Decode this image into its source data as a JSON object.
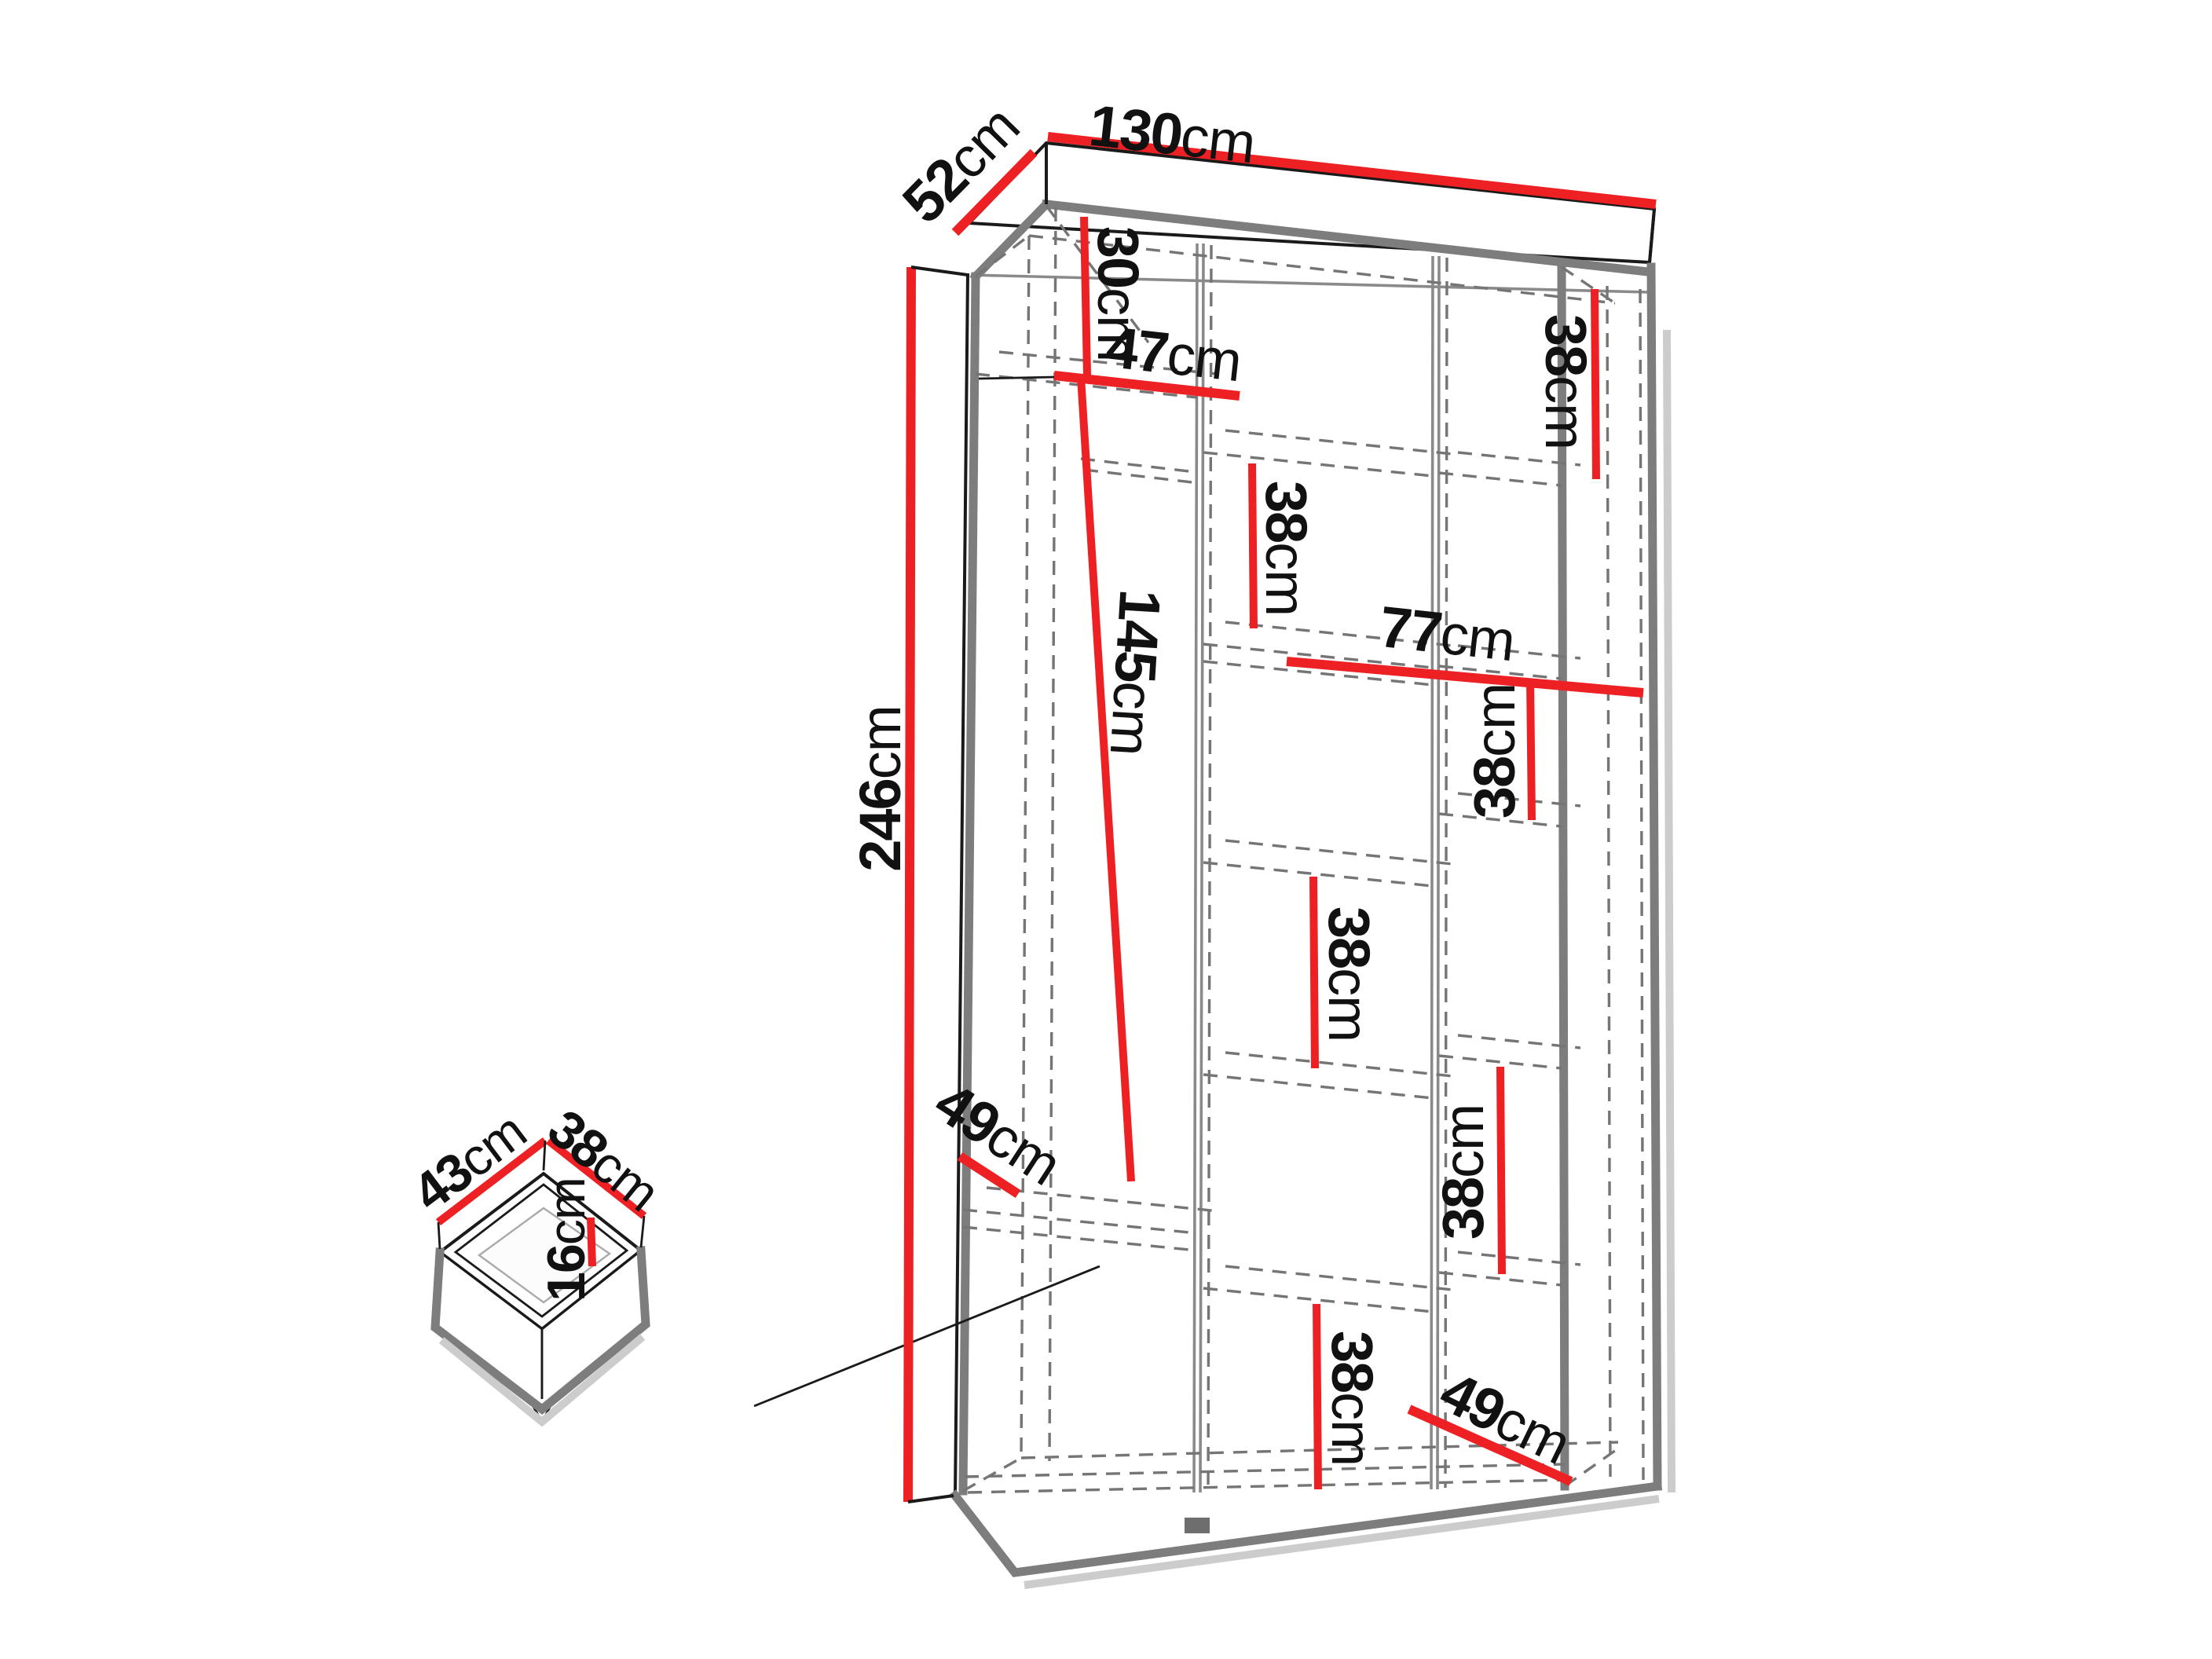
{
  "diagram_type": "wardrobe-dimension-drawing",
  "colors": {
    "dimension_red": "#ed2024",
    "frame_gray": "#7d7d7d",
    "dashed_gray": "#757575",
    "outline_black": "#1a1a1a"
  },
  "dims": {
    "width": {
      "v": "130",
      "u": "cm"
    },
    "depth": {
      "v": "52",
      "u": "cm"
    },
    "height": {
      "v": "246",
      "u": "cm"
    },
    "top_gap": {
      "v": "30",
      "u": "cm"
    },
    "left_shelf_width": {
      "v": "47",
      "u": "cm"
    },
    "hanging_height": {
      "v": "145",
      "u": "cm"
    },
    "left_depth": {
      "v": "49",
      "u": "cm"
    },
    "right_width": {
      "v": "77",
      "u": "cm"
    },
    "bottom_right_depth": {
      "v": "49",
      "u": "cm"
    },
    "compartments": [
      {
        "v": "38",
        "u": "cm"
      },
      {
        "v": "38",
        "u": "cm"
      },
      {
        "v": "38",
        "u": "cm"
      },
      {
        "v": "38",
        "u": "cm"
      },
      {
        "v": "38",
        "u": "cm"
      },
      {
        "v": "38",
        "u": "cm"
      }
    ]
  },
  "drawer": {
    "width": {
      "v": "43",
      "u": "cm"
    },
    "depth": {
      "v": "38",
      "u": "cm"
    },
    "height": {
      "v": "16",
      "u": "cm"
    }
  }
}
